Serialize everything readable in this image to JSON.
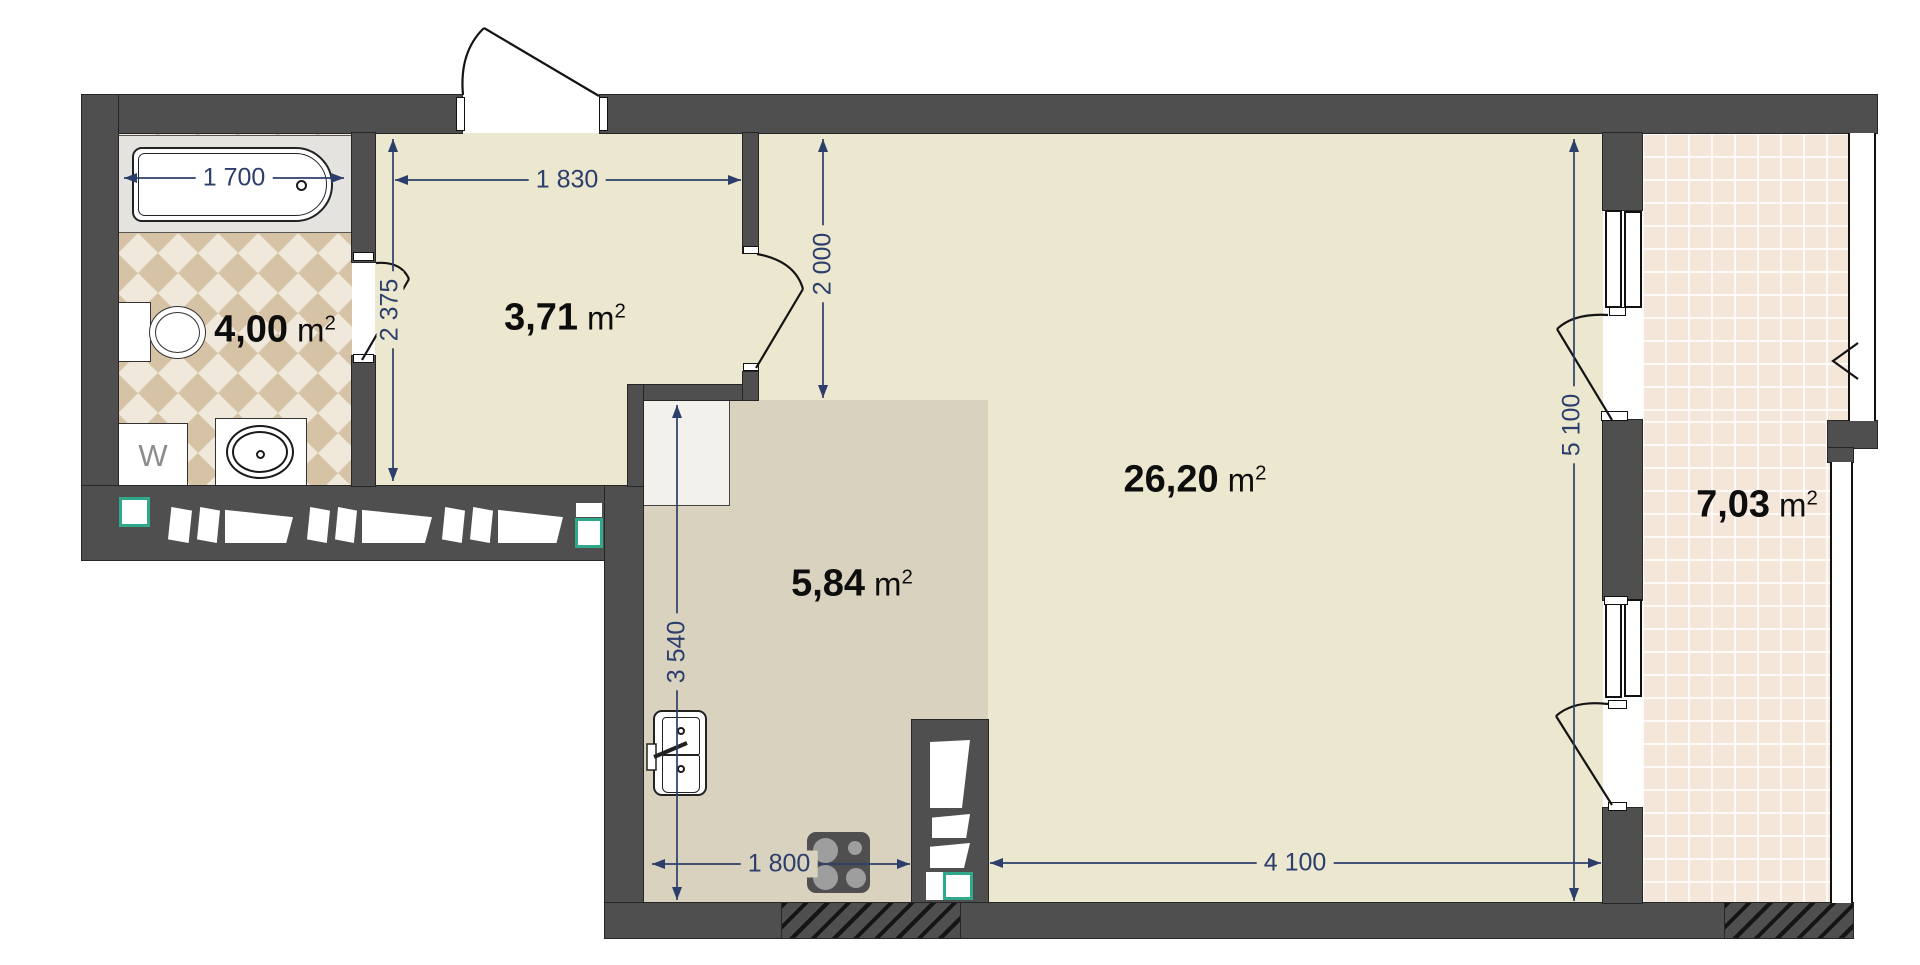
{
  "rooms": {
    "bathroom": "4,00",
    "hallway": "3,71",
    "kitchen": "5,84",
    "living": "26,20",
    "balcony": "7,03"
  },
  "area_unit": {
    "base": "m",
    "sup": "2"
  },
  "dims": {
    "bathtub": "1 700",
    "hallway_width": "1 830",
    "hallway_depth": "2 375",
    "living_entry": "2 000",
    "kitchen_depth": "3 540",
    "kitchen_width": "1 800",
    "living_width": "4 100",
    "living_depth": "5 100"
  },
  "labels": {
    "washing_machine": "W"
  },
  "colors": {
    "wall": "#4f4f4f",
    "floor": "#ece7cf",
    "kitchen_floor": "#d9d2bf",
    "balcony_floor": "#f5e6da",
    "bathroom_tile_dark": "#d6c3a5",
    "bathroom_tile_light": "#f0e9db",
    "dimension": "#2c3e6b",
    "vent_marker_green": "#2fa98c"
  }
}
